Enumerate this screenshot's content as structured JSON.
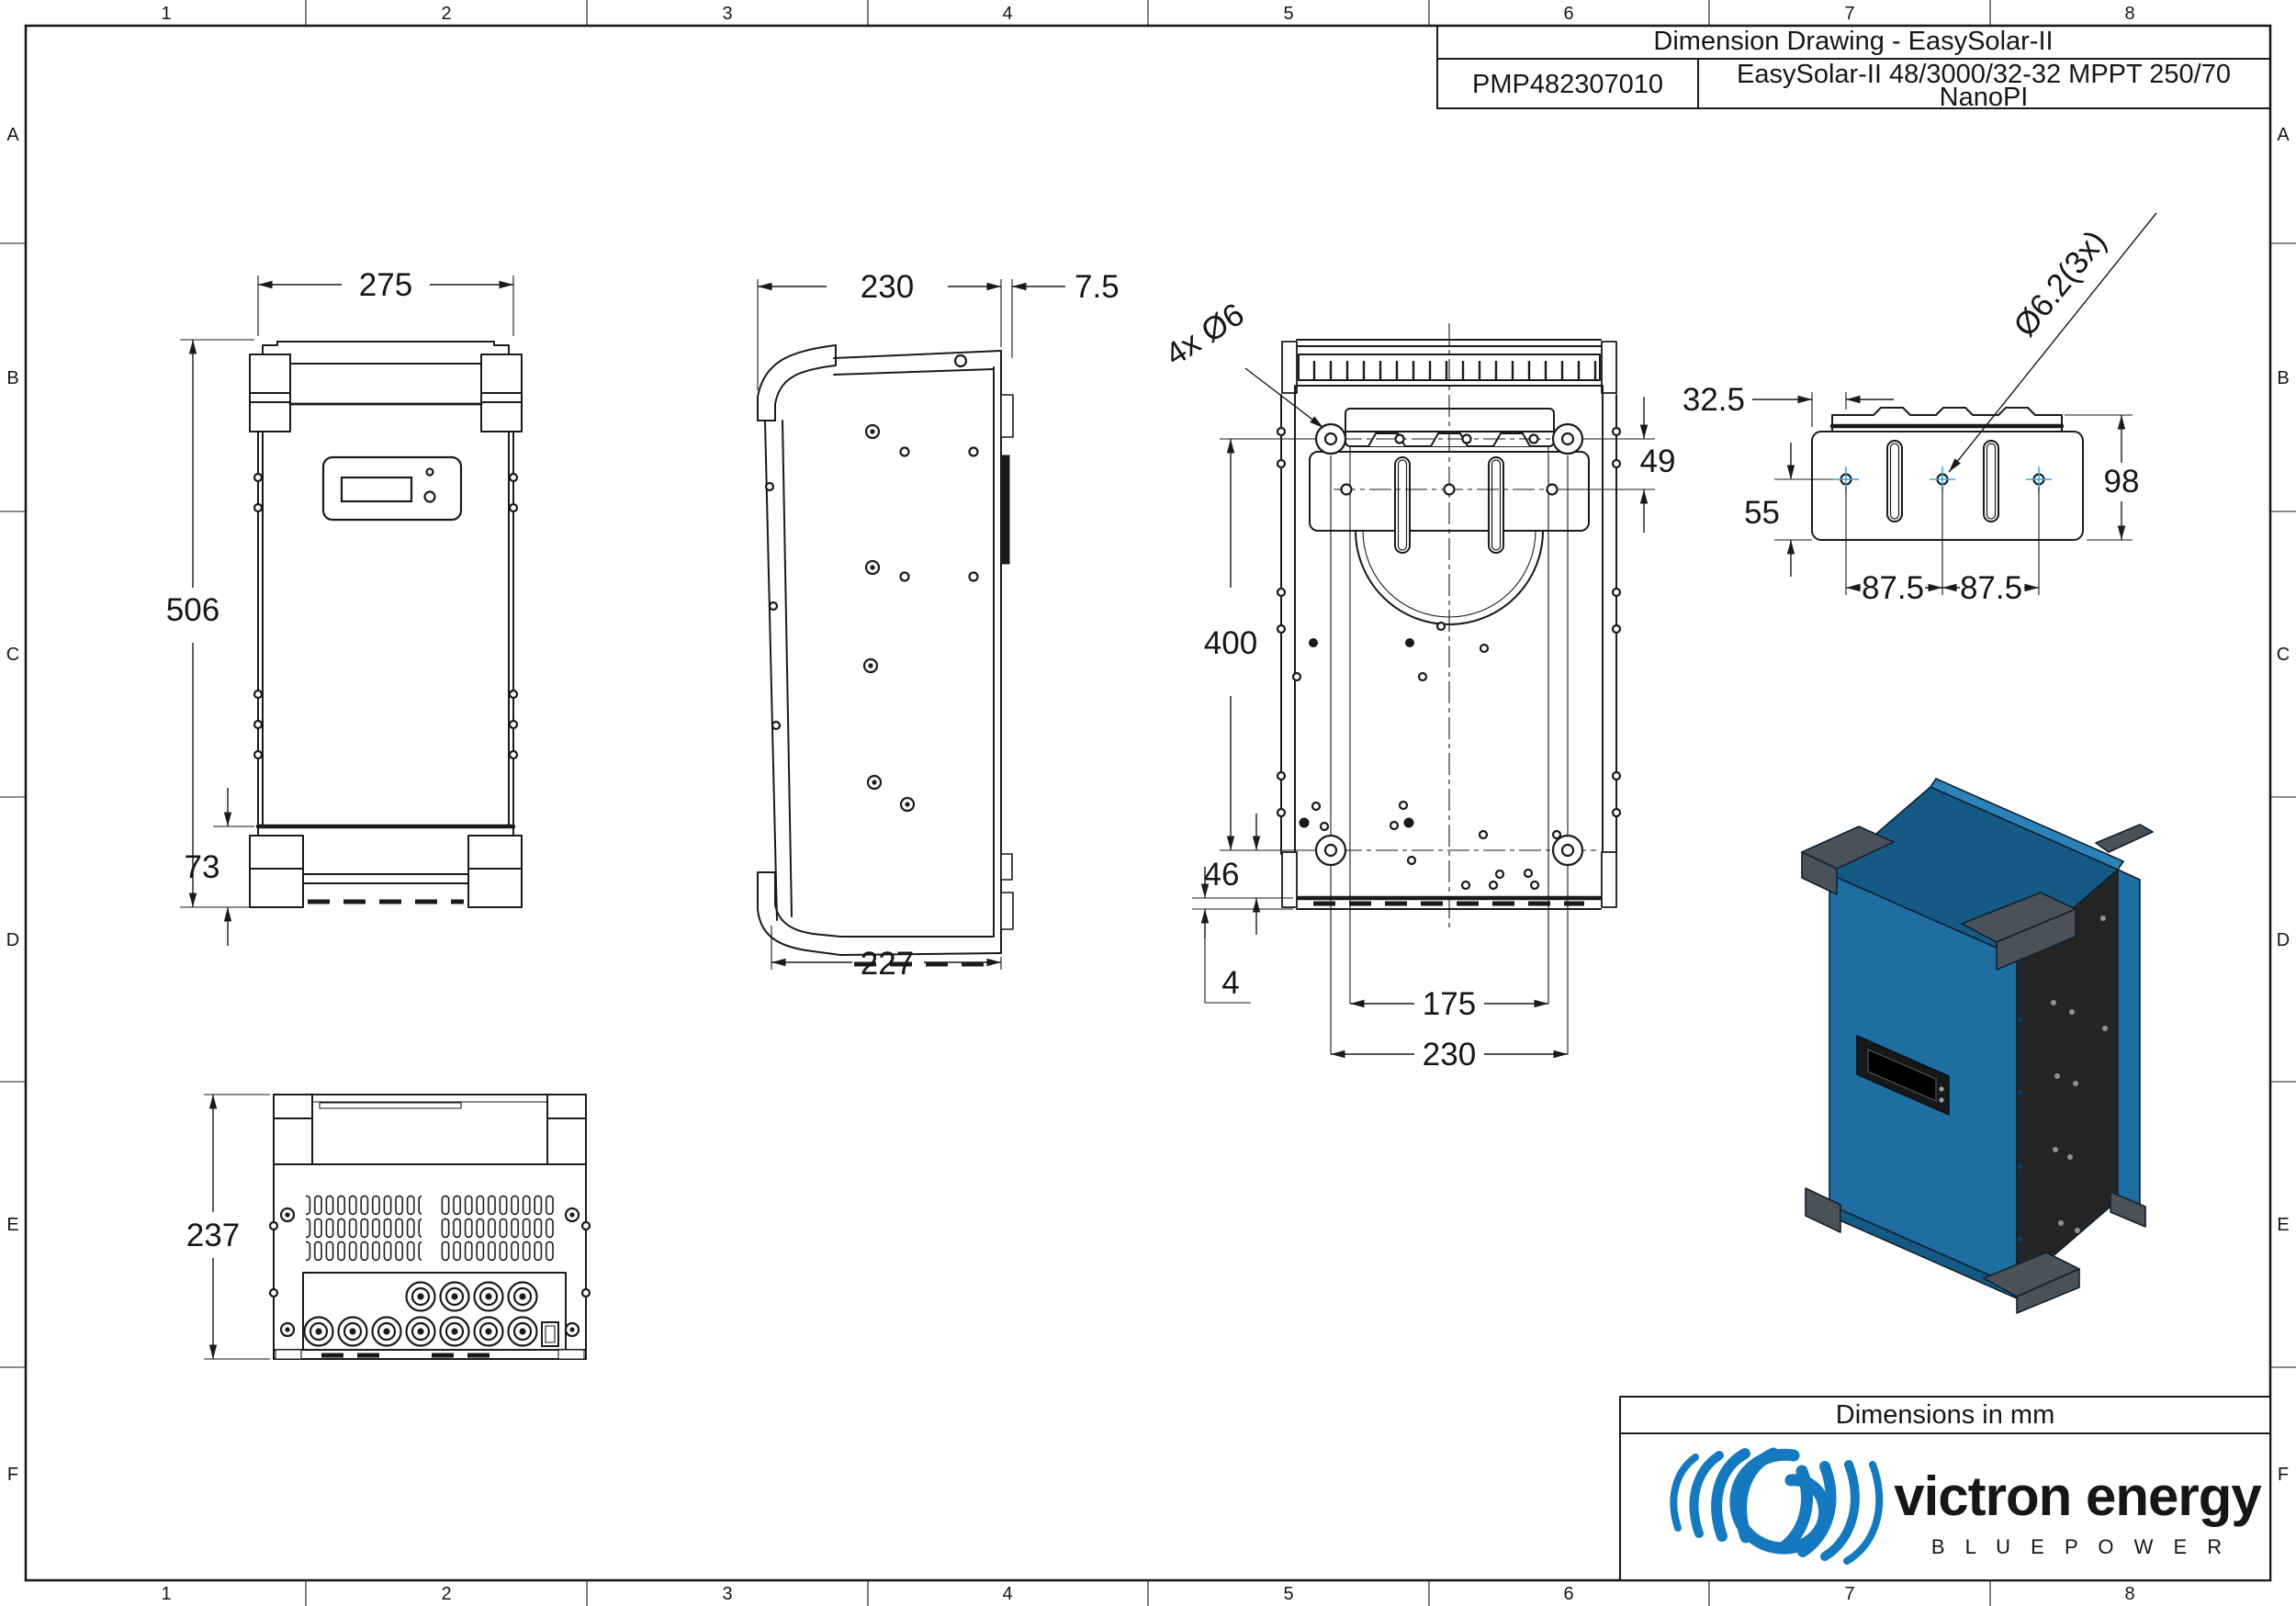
{
  "title_block": {
    "title": "Dimension Drawing - EasySolar-II",
    "part_number": "PMP482307010",
    "description_line1": "EasySolar-II 48/3000/32-32 MPPT 250/70",
    "description_line2": "NanoPI"
  },
  "border": {
    "columns": [
      "1",
      "2",
      "3",
      "4",
      "5",
      "6",
      "7",
      "8"
    ],
    "rows": [
      "A",
      "B",
      "C",
      "D",
      "E",
      "F"
    ]
  },
  "views": {
    "front": {
      "width": "275",
      "height": "506",
      "foot_height": "73"
    },
    "side": {
      "depth_top": "230",
      "bracket_offset": "7.5",
      "depth_bottom": "227"
    },
    "back": {
      "holes_note": "4x Ø6",
      "bracket_to_holes": "49",
      "hole_spacing_vertical": "400",
      "bottom_offset": "46",
      "plate_thickness": "4",
      "slot_spacing": "175",
      "hole_spacing_horizontal": "230"
    },
    "bracket": {
      "edge_to_hole": "32.5",
      "hole_to_bottom": "55",
      "hole_spacing": [
        "87.5",
        "87.5"
      ],
      "height": "98",
      "holes_note": "Ø6.2(3x)"
    },
    "bottom": {
      "depth": "237"
    }
  },
  "footer": {
    "units_note": "Dimensions in mm"
  },
  "logo": {
    "brand": "victron energy",
    "tagline": "B L U E   P O W E R"
  },
  "colors": {
    "logo_blue": "#1579C0",
    "product_blue": "#1E6EA4",
    "product_blue_top": "#155A85",
    "product_blue_edge": "#2B82BB",
    "panel_black": "#242424",
    "corner_gray": "#4A5158",
    "centermark_blue": "#2FA8E0"
  }
}
